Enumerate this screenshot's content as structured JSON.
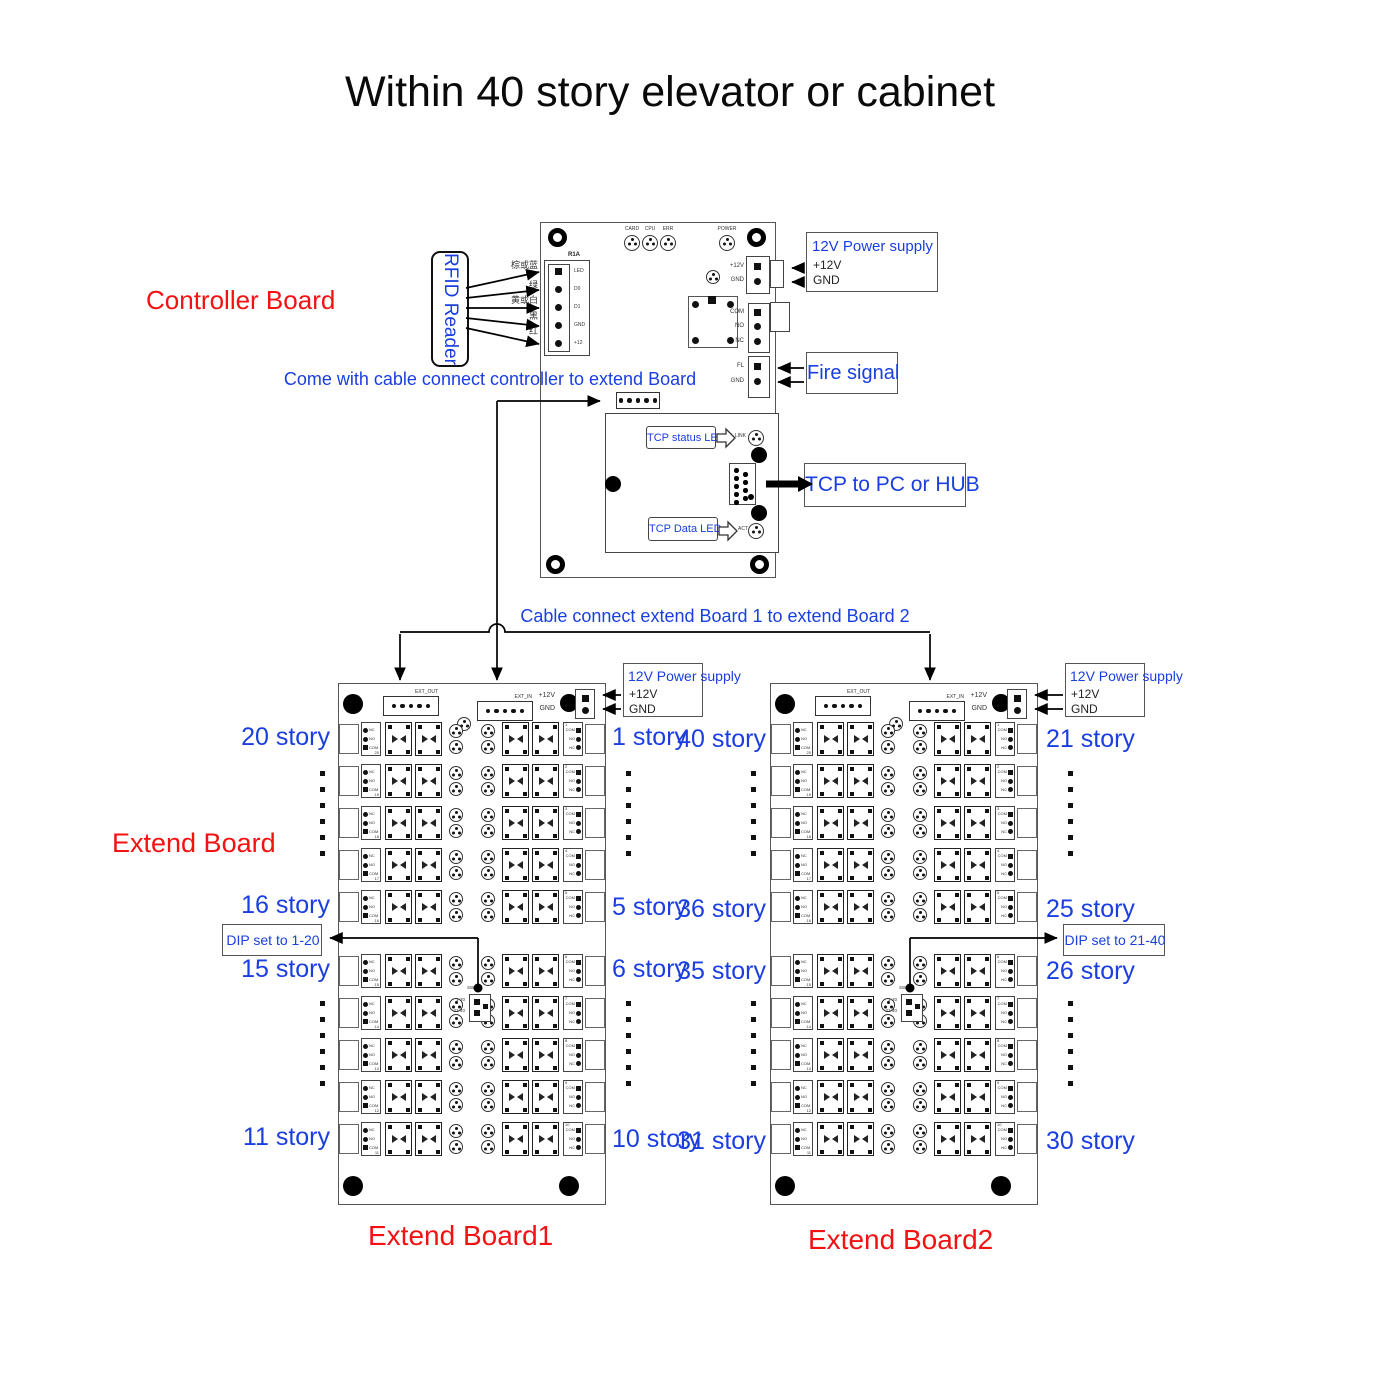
{
  "title": "Within 40 story elevator or cabinet",
  "colors": {
    "blue": "#1a3ee0",
    "red": "#f31112",
    "ink": "#111111"
  },
  "annotations": {
    "controller_board": "Controller Board",
    "extend_board": "Extend Board",
    "come_with_cable": "Come with cable connect controller to extend Board",
    "cable_between": "Cable connect extend Board 1 to extend Board 2"
  },
  "power_supply": {
    "title": "12V Power supply",
    "pin1": "+12V",
    "pin2": "GND"
  },
  "controller": {
    "rfid_reader": "RFID Reader",
    "wire_labels": [
      "棕或蓝",
      "绿",
      "黄或白",
      "黑",
      "红"
    ],
    "reader_port": {
      "name": "R1A",
      "pins": [
        "LED",
        "D0",
        "D1",
        "GND",
        "+12"
      ]
    },
    "status_leds": [
      "CARD",
      "CPU",
      "ERR"
    ],
    "power_led": "POWER",
    "power_pins": [
      "+12V",
      "GND"
    ],
    "relay_pins": [
      "COM",
      "NO",
      "NC"
    ],
    "fire_pins": [
      "FL",
      "GND"
    ],
    "fire_signal": "Fire signal",
    "tcp": {
      "status_led": "TCP status LED",
      "data_led": "TCP Data LED",
      "link": "LINK",
      "act": "ACT",
      "to_pc": "TCP to PC or HUB"
    }
  },
  "board_template": {
    "ext_out": "EXT_OUT",
    "ext_in": "EXT_IN",
    "left_pins": [
      "NC",
      "NO",
      "COM"
    ],
    "right_pins": [
      "COM",
      "NO",
      "NC"
    ],
    "left_numbers": [
      20,
      19,
      18,
      17,
      16,
      15,
      14,
      13,
      12,
      11
    ],
    "right_numbers": [
      1,
      2,
      3,
      4,
      5,
      6,
      7,
      8,
      9,
      10
    ],
    "dip_name": "SW4",
    "dip_options": [
      "1-20",
      "21-40"
    ]
  },
  "extend_boards": [
    {
      "name": "Extend Board1",
      "dip_label": "DIP set to 1-20",
      "stories_left": [
        "20 story",
        "16 story",
        "15 story",
        "11 story"
      ],
      "stories_right": [
        "1 story",
        "5 story",
        "6 story",
        "10 story"
      ]
    },
    {
      "name": "Extend Board2",
      "dip_label": "DIP set to 21-40",
      "stories_left": [
        "40 story",
        "36 story",
        "35 story",
        "31 story"
      ],
      "stories_right": [
        "21 story",
        "25 story",
        "26 story",
        "30 story"
      ]
    }
  ]
}
